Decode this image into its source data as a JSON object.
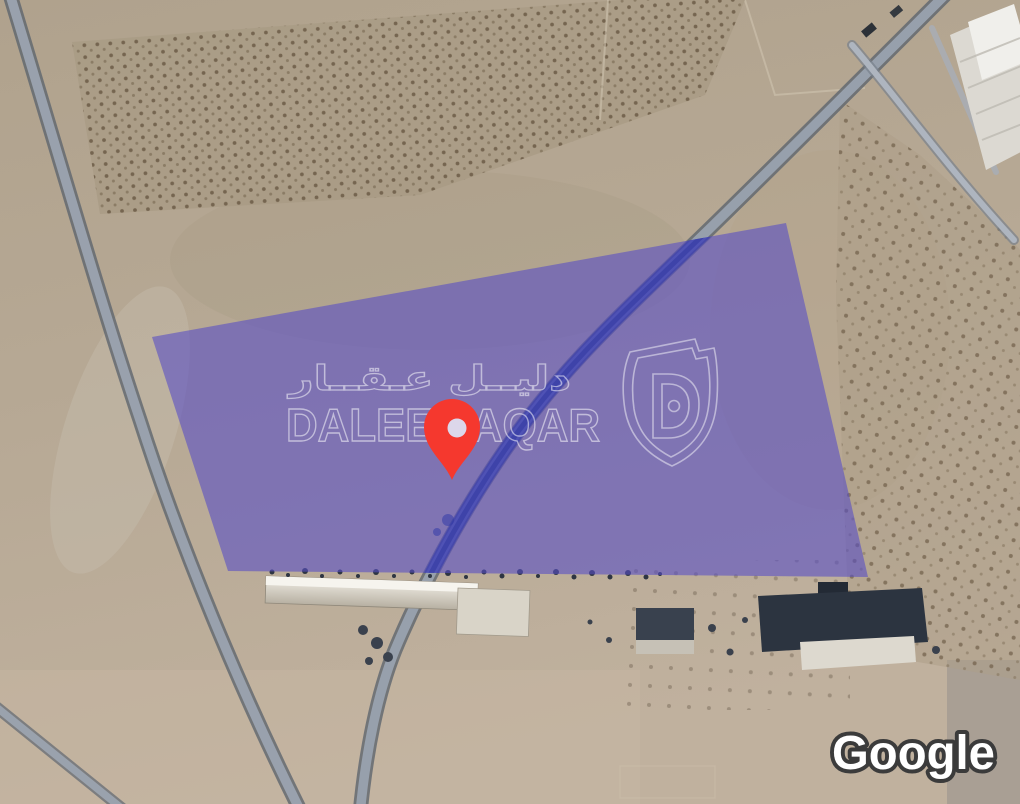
{
  "attribution": {
    "provider": "Google"
  },
  "watermark": {
    "arabic_text": "دليــل عـقــار",
    "latin_text": "DALEEL AQAR",
    "logo": "daleel-aqar-shield"
  },
  "overlay": {
    "type": "land-parcel-highlight",
    "parcel_fill": "#584ec4",
    "parcel_opacity": "0.6",
    "parcel_points": "152,337 786,223 868,577 228,571",
    "pin_color": "#f5382e"
  }
}
